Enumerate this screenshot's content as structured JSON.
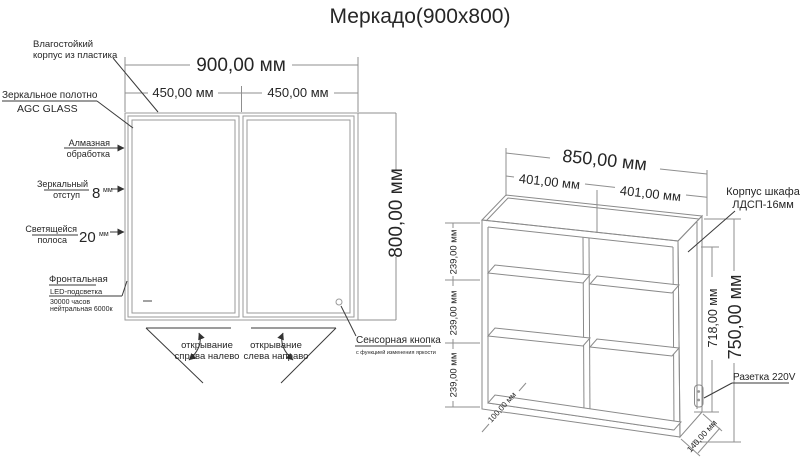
{
  "title": "Меркадо(900x800)",
  "mirror": {
    "dims": {
      "width": "900,00 мм",
      "half_left": "450,00 мм",
      "half_right": "450,00 мм",
      "height": "800,00 мм"
    },
    "labels": {
      "case": [
        "Влагостойкий",
        "корпус из пластика"
      ],
      "glass": [
        "Зеркальное полотно",
        "AGC GLASS"
      ],
      "diamond": [
        "Алмазная",
        "обработка"
      ],
      "offset": {
        "line1": "Зеркальный",
        "line2": "отступ",
        "value": "8",
        "unit": "мм"
      },
      "strip": {
        "line1": "Светящейся",
        "line2": "полоса",
        "value": "20",
        "unit": "мм"
      },
      "led": [
        "Фронтальная",
        "LED-подсветка",
        "30000 часов",
        "нейтральная 6000к"
      ],
      "sensor": {
        "title": "Сенсорная кнопка",
        "subtitle": "с функцией изменения яркости"
      },
      "open_left": [
        "открывание",
        "справа налево"
      ],
      "open_right": [
        "открывание",
        "слева направо"
      ]
    }
  },
  "cabinet": {
    "dims": {
      "width": "850,00 мм",
      "half_left": "401,00 мм",
      "half_right": "401,00 мм",
      "shelf_spacings": [
        "239,00 мм",
        "239,00 мм",
        "239,00 мм"
      ],
      "inner_height": "718,00 мм",
      "height": "750,00 мм",
      "depth": "140,00 мм",
      "inner_depth": "100,00 мм"
    },
    "labels": {
      "body": [
        "Корпус шкафа",
        "ЛДСП-16мм"
      ],
      "socket": "Разетка 220V"
    }
  }
}
